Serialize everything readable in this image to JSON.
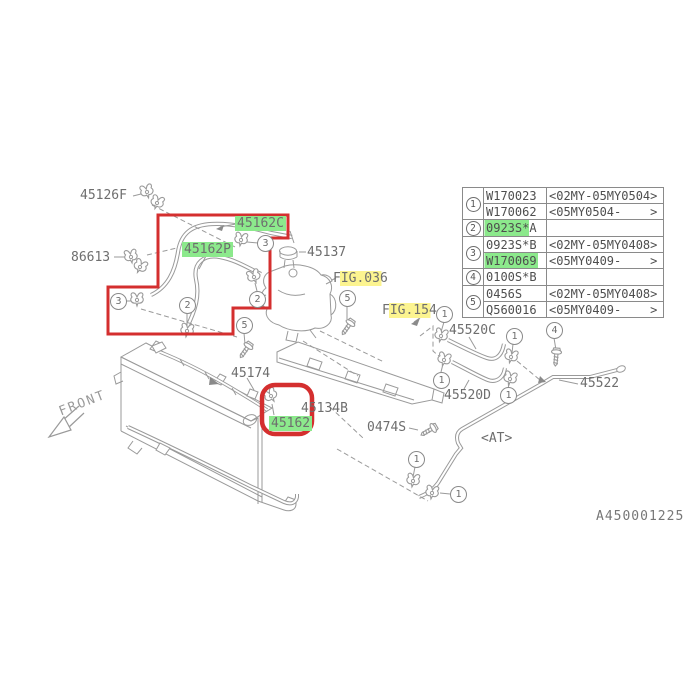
{
  "page": {
    "drawing_number": "A450001225",
    "front_label": "FRONT",
    "at_label": "<AT>"
  },
  "labels": {
    "p45126F": "45126F",
    "p86613": "86613",
    "p45162C": "45162C",
    "p45162P": "45162P",
    "p45137": "45137",
    "fig036": "FIG.036",
    "fig154": "FIG.154",
    "p45174": "45174",
    "p45134B": "45134B",
    "p45162": "45162",
    "p0474S": "0474S",
    "p45520C": "45520C",
    "p45520D": "45520D",
    "p45522": "45522"
  },
  "callouts": {
    "c1": "1",
    "c2": "2",
    "c3": "3",
    "c4": "4",
    "c5": "5"
  },
  "table": {
    "refs": [
      "1",
      "2",
      "3",
      "4",
      "5"
    ],
    "rows": [
      {
        "part": "W170023",
        "range": "<02MY-05MY0504>"
      },
      {
        "part": "W170062",
        "range": "<05MY0504-    >"
      },
      {
        "part": "0923S*A",
        "range": ""
      },
      {
        "part": "0923S*B",
        "range": "<02MY-05MY0408>"
      },
      {
        "part": "W170069",
        "range": "<05MY0409-    >"
      },
      {
        "part": "0100S*B",
        "range": ""
      },
      {
        "part": "0456S",
        "range": "<02MY-05MY0408>"
      },
      {
        "part": "Q560016",
        "range": "<05MY0409-    >"
      }
    ]
  },
  "colors": {
    "highlight_green": "#8ce98c",
    "highlight_yellow": "#fcf490",
    "outline_red": "#d42f2f",
    "line_gray": "#9a9a9a",
    "text_gray": "#6e6e6e"
  }
}
